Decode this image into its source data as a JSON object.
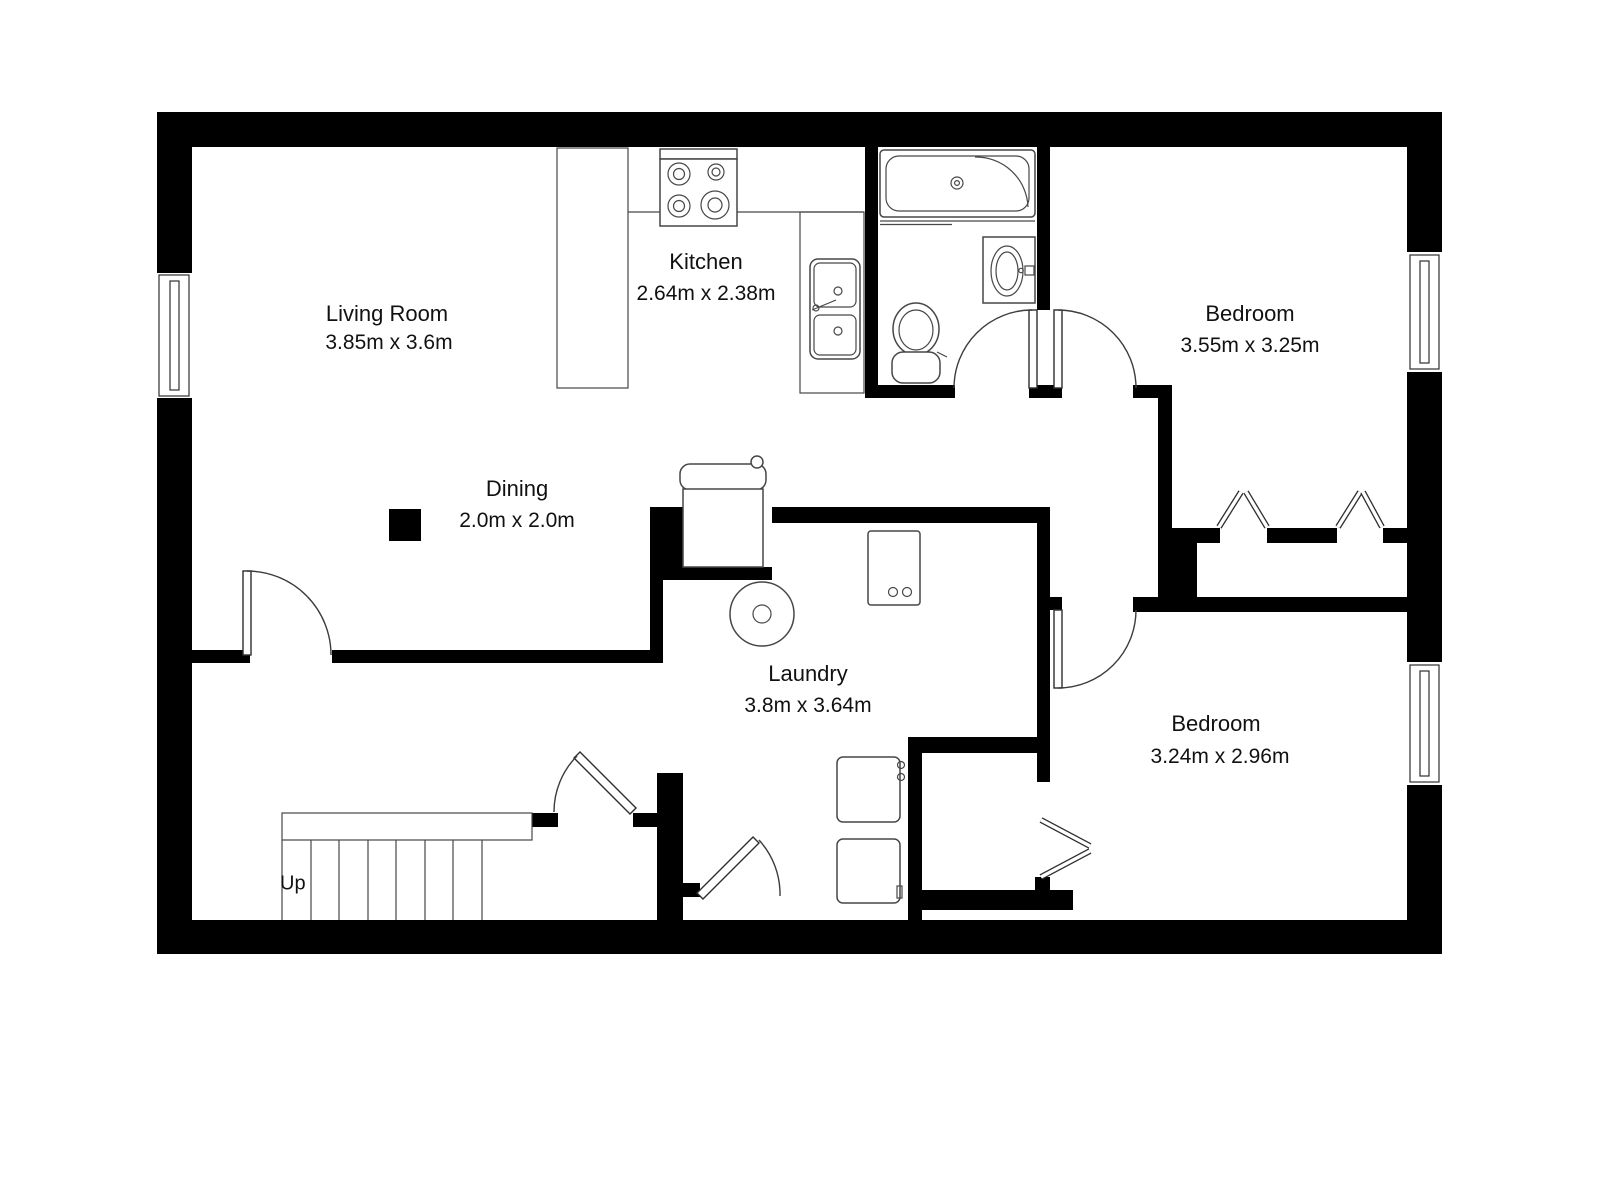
{
  "plan": {
    "background_color": "#ffffff",
    "wall_color": "#000000",
    "fixture_line_color": "#474747",
    "text_color": "#111111",
    "rooms": [
      {
        "id": "living-room",
        "name": "Living Room",
        "dims": "3.85m x 3.6m"
      },
      {
        "id": "kitchen",
        "name": "Kitchen",
        "dims": "2.64m x 2.38m"
      },
      {
        "id": "dining",
        "name": "Dining",
        "dims": "2.0m x 2.0m"
      },
      {
        "id": "laundry",
        "name": "Laundry",
        "dims": "3.8m x 3.64m"
      },
      {
        "id": "bedroom-1",
        "name": "Bedroom",
        "dims": "3.55m x 3.25m"
      },
      {
        "id": "bedroom-2",
        "name": "Bedroom",
        "dims": "3.24m x 2.96m"
      }
    ],
    "stairs": {
      "label": "Up"
    },
    "fixtures": [
      "bathtub",
      "shower-screen",
      "vanity-sink",
      "toilet",
      "stove-4-burner",
      "kitchen-counter",
      "double-kitchen-sink",
      "washing-machine",
      "water-heater",
      "cabinet",
      "appliance-upper",
      "appliance-lower",
      "stairs-up",
      "dining-column",
      "window-left",
      "window-bedroom-1",
      "window-bedroom-2",
      "door-living-room",
      "door-bathroom",
      "door-bedroom-1",
      "door-bedroom-2",
      "door-under-stairs",
      "door-laundry-nook",
      "closet-doors-bedroom-1",
      "closet-door-bedroom-2"
    ]
  }
}
